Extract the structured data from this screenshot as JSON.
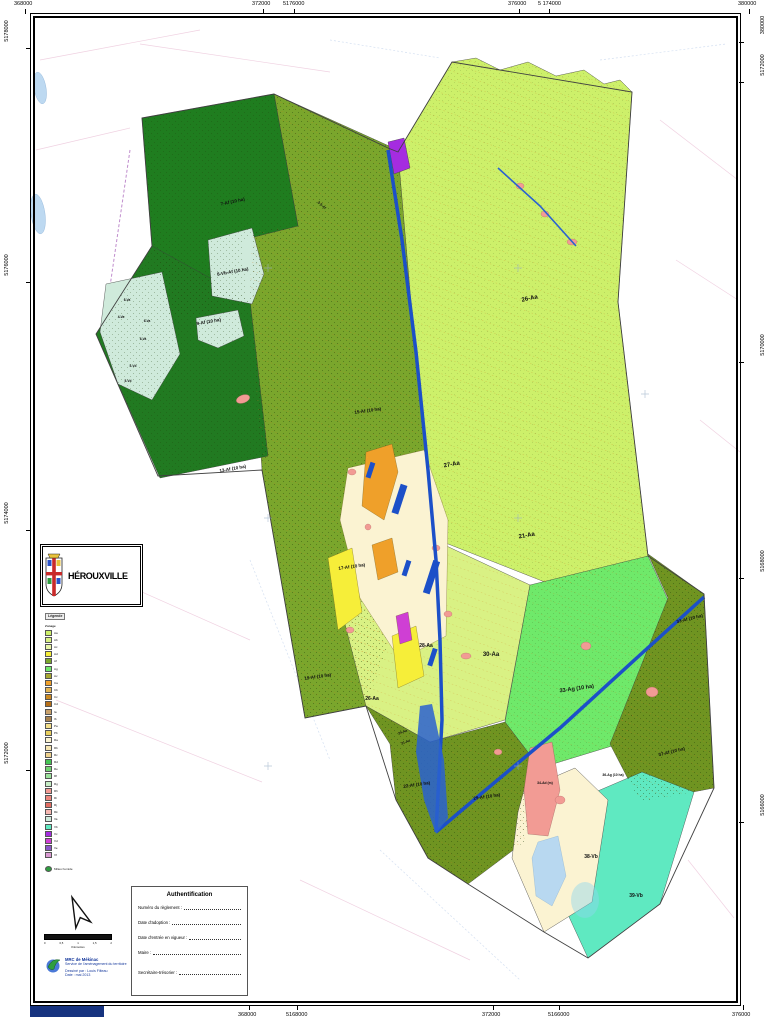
{
  "title_block": {
    "municipality": "HÉROUXVILLE"
  },
  "frame": {
    "top_labels": [
      {
        "text": "368000",
        "x": 14
      },
      {
        "text": "372000",
        "x": 252
      },
      {
        "text": "5176000",
        "x": 283
      },
      {
        "text": "376000",
        "x": 508
      },
      {
        "text": "5 174000",
        "x": 538
      },
      {
        "text": "380000",
        "x": 738
      }
    ],
    "bottom_labels": [
      {
        "text": "5170000",
        "x": 46
      },
      {
        "text": "368000",
        "x": 238
      },
      {
        "text": "5168000",
        "x": 286
      },
      {
        "text": "372000",
        "x": 482
      },
      {
        "text": "5166000",
        "x": 548
      },
      {
        "text": "376000",
        "x": 732
      }
    ],
    "left_labels": [
      {
        "text": "5178000",
        "y": 28
      },
      {
        "text": "5176000",
        "y": 262
      },
      {
        "text": "5174000",
        "y": 510
      },
      {
        "text": "5172000",
        "y": 750
      }
    ],
    "right_labels": [
      {
        "text": "380000",
        "y": 22
      },
      {
        "text": "5172000",
        "y": 62
      },
      {
        "text": "5170000",
        "y": 342
      },
      {
        "text": "5168000",
        "y": 558
      },
      {
        "text": "5166000",
        "y": 802
      }
    ]
  },
  "map": {
    "zone_labels": [
      {
        "t": "7-Af (10 ha)",
        "x": 233,
        "y": 203,
        "r": -12
      },
      {
        "t": "3-5-Af",
        "x": 321,
        "y": 206,
        "r": 42,
        "s": 3.6
      },
      {
        "t": "8-Vb-Af (10 ha)",
        "x": 233,
        "y": 273,
        "r": -10
      },
      {
        "t": "9-Af (10 ha)",
        "x": 209,
        "y": 323,
        "r": -10
      },
      {
        "t": "13-Af (10 ha)",
        "x": 233,
        "y": 470,
        "r": -10
      },
      {
        "t": "15-Af (10 ha)",
        "x": 368,
        "y": 412,
        "r": -8
      },
      {
        "t": "17-Af (10 ha)",
        "x": 352,
        "y": 568,
        "r": -8
      },
      {
        "t": "19-Af (10 ha)",
        "x": 318,
        "y": 678,
        "r": -8
      },
      {
        "t": "26-Aa",
        "x": 530,
        "y": 300,
        "r": -12,
        "s": 6
      },
      {
        "t": "27-Aa",
        "x": 452,
        "y": 466,
        "r": -10,
        "s": 6
      },
      {
        "t": "21-Aa",
        "x": 527,
        "y": 537,
        "r": -10,
        "s": 6
      },
      {
        "t": "28-Aa",
        "x": 426,
        "y": 647,
        "s": 5
      },
      {
        "t": "30-Aa",
        "x": 491,
        "y": 656,
        "s": 6
      },
      {
        "t": "26-Aa",
        "x": 372,
        "y": 700,
        "s": 5
      },
      {
        "t": "24-Aa",
        "x": 403,
        "y": 733,
        "r": -20,
        "s": 3.4
      },
      {
        "t": "21-Aa",
        "x": 406,
        "y": 743,
        "r": -20,
        "s": 3.4
      },
      {
        "t": "33-Ag (10 ha)",
        "x": 577,
        "y": 690,
        "r": -8,
        "s": 5.5
      },
      {
        "t": "33-Af (10 ha)",
        "x": 690,
        "y": 620,
        "r": -14
      },
      {
        "t": "37-Af (10 ha)",
        "x": 672,
        "y": 753,
        "r": -14
      },
      {
        "t": "36-Ag (10 ha)",
        "x": 613,
        "y": 776,
        "s": 3.4
      },
      {
        "t": "34-Ad (m)",
        "x": 545,
        "y": 784,
        "s": 3.4
      },
      {
        "t": "22-Af (10 ha)",
        "x": 417,
        "y": 786,
        "r": -8
      },
      {
        "t": "29-Af (10 ha)",
        "x": 487,
        "y": 798,
        "r": -8
      },
      {
        "t": "38-Vb",
        "x": 591,
        "y": 858,
        "s": 5
      },
      {
        "t": "39-Vb",
        "x": 636,
        "y": 897,
        "s": 5
      },
      {
        "t": "6-Va",
        "x": 127,
        "y": 301,
        "s": 3.2
      },
      {
        "t": "4-Va",
        "x": 121,
        "y": 318,
        "s": 3.2
      },
      {
        "t": "6-Va",
        "x": 147,
        "y": 322,
        "s": 3.2
      },
      {
        "t": "6-Va",
        "x": 143,
        "y": 340,
        "s": 3.2
      },
      {
        "t": "5-Vd",
        "x": 133,
        "y": 367,
        "s": 3.2
      },
      {
        "t": "5-Vd",
        "x": 128,
        "y": 382,
        "s": 3.2
      }
    ],
    "colors": {
      "zone_aa": "#cdf06a",
      "zone_aa_pale": "#d9f184",
      "zone_af_olive": "#7aa62c",
      "zone_af_dark": "#6f9421",
      "forest_dark": "#1f7d1f",
      "zone_ag": "#6fe96a",
      "zone_vb_teal": "#5fe9c1",
      "zone_va_mint": "#cfeadb",
      "village_cream": "#fbf3d2",
      "commercial_orange": "#efa02a",
      "public_yellow": "#f6ee39",
      "ad_pink": "#f29b94",
      "purple": "#a52ce0",
      "magenta": "#cf3fd4",
      "road_blue": "#1c50c8",
      "lake_blue": "#bdd9f1"
    }
  },
  "legend": {
    "header": "Légende",
    "subtitle": "Zonage",
    "items": [
      {
        "label": "Aa",
        "color": "#cdf06a"
      },
      {
        "label": "Ab",
        "color": "#d9f184"
      },
      {
        "label": "Ac",
        "color": "#e8f6a8"
      },
      {
        "label": "Ad",
        "color": "#f6ee39"
      },
      {
        "label": "Af",
        "color": "#7aa62c"
      },
      {
        "label": "Ag",
        "color": "#6fe96a"
      },
      {
        "label": "Av",
        "color": "#a8a832"
      },
      {
        "label": "Ca",
        "color": "#efa02a"
      },
      {
        "label": "Cb",
        "color": "#e2b455"
      },
      {
        "label": "Cc",
        "color": "#cc8a22"
      },
      {
        "label": "Cd",
        "color": "#b87018"
      },
      {
        "label": "Ia",
        "color": "#c9a16b"
      },
      {
        "label": "Ib",
        "color": "#a8824e"
      },
      {
        "label": "Pa",
        "color": "#f4e08a"
      },
      {
        "label": "Pb",
        "color": "#e8cf5e"
      },
      {
        "label": "Ra",
        "color": "#fbf3d2"
      },
      {
        "label": "Rb",
        "color": "#f6e6b2"
      },
      {
        "label": "Rc",
        "color": "#efd28e"
      },
      {
        "label": "Rd",
        "color": "#46c455"
      },
      {
        "label": "Re",
        "color": "#72d472"
      },
      {
        "label": "Rf",
        "color": "#9ce29c"
      },
      {
        "label": "Rg",
        "color": "#c6eec6"
      },
      {
        "label": "Rh",
        "color": "#f29b94"
      },
      {
        "label": "Ri",
        "color": "#ec867d"
      },
      {
        "label": "Rj",
        "color": "#e26d62"
      },
      {
        "label": "Rk",
        "color": "#f6b7b1"
      },
      {
        "label": "Va",
        "color": "#cfeadb"
      },
      {
        "label": "Vb",
        "color": "#5fe9c1"
      },
      {
        "label": "Vc",
        "color": "#a52ce0"
      },
      {
        "label": "Vd",
        "color": "#cf3fd4"
      },
      {
        "label": "Ve",
        "color": "#8a56c8"
      },
      {
        "label": "Vf",
        "color": "#da9ad2"
      }
    ],
    "extra": {
      "label": "Milieu humide",
      "color": "#2f9e3f"
    }
  },
  "scalebar": {
    "ticks": [
      "0",
      "0,5",
      "1",
      "1,5",
      "2"
    ],
    "unit": "Kilomètres"
  },
  "credits": {
    "org": "MRC de Mékinac",
    "dept": "Service de l'aménagement du territoire",
    "drawn": "Dessiné par : Louis Filteau",
    "date": "Date : mai 2013"
  },
  "auth": {
    "title": "Authentification",
    "fields": [
      "Numéro du règlement :",
      "Date d'adoption :",
      "Date d'entrée en vigueur :",
      "Maire :",
      "Secrétaire-trésorier :"
    ]
  }
}
